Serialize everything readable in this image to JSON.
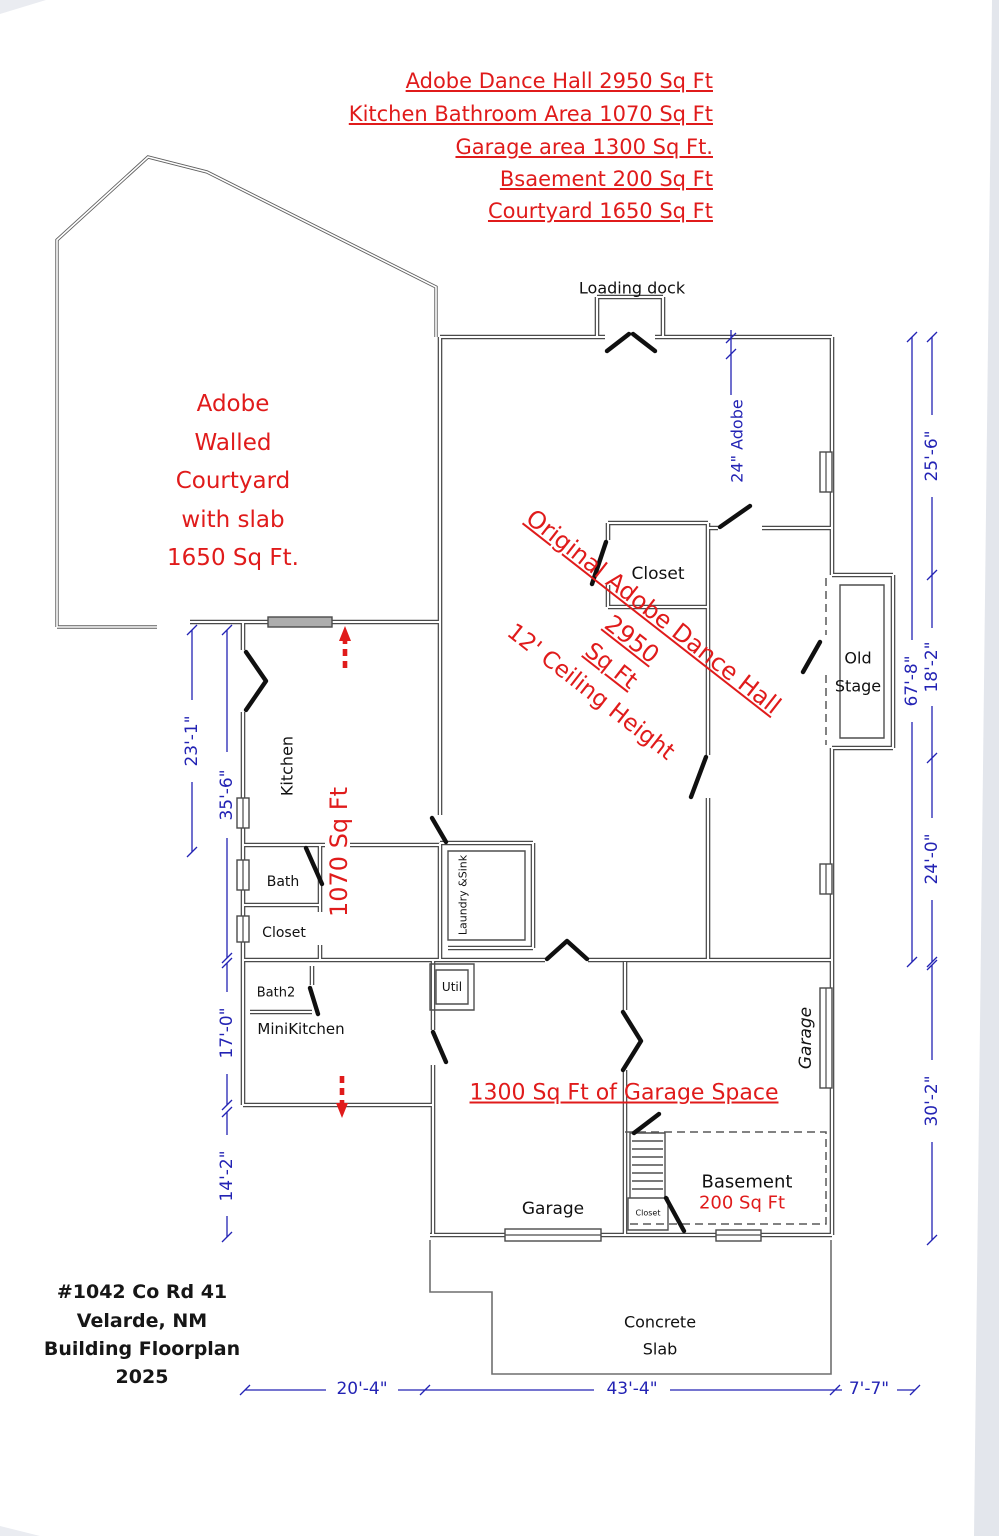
{
  "colors": {
    "annotation_red": "#e01b1b",
    "dimension_blue": "#2323b4",
    "wall_gray": "#4a4a4a"
  },
  "title": {
    "lines": [
      "Adobe Dance Hall 2950 Sq Ft",
      "Kitchen Bathroom Area 1070 Sq Ft",
      "Garage area 1300 Sq Ft.",
      "Bsaement 200 Sq Ft",
      "Courtyard 1650 Sq Ft"
    ]
  },
  "courtyard_label": {
    "lines": [
      "Adobe",
      "Walled",
      "Courtyard",
      "with slab",
      "1650 Sq Ft."
    ]
  },
  "hall_note": {
    "line1": "Original Adobe Dance Hall  2950",
    "line2": "Sq Ft",
    "line3": "12' Ceiling Height"
  },
  "labels": {
    "loading_dock": "Loading dock",
    "adobe_wall": "24\" Adobe",
    "closet_hall": "Closet",
    "old": "Old",
    "stage": "Stage",
    "kitchen": "Kitchen",
    "kitchen_sqft": "1070 Sq Ft",
    "bath": "Bath",
    "closet_kitchen": "Closet",
    "laundry": "Laundry &Sink",
    "bath2": "Bath2",
    "minikitchen": "MiniKitchen",
    "util": "Util",
    "garage_right": "Garage",
    "garage_note": "1300 Sq Ft of Garage Space",
    "garage_left": "Garage",
    "basement": "Basement",
    "basement_sqft": "200 Sq Ft",
    "stairs_closet": "Closet",
    "concrete": "Concrete",
    "slab": "Slab"
  },
  "dims": {
    "left": [
      "23'-1\"",
      "35'-6\"",
      "17'-0\"",
      "14'-2\""
    ],
    "right": [
      "25'-6\"",
      "18'-2\"",
      "67'-8\"",
      "24'-0\"",
      "30'-2\""
    ],
    "bottom": [
      "20'-4\"",
      "43'-4\"",
      "7'-7\""
    ]
  },
  "address": {
    "lines": [
      "#1042 Co Rd 41",
      "Velarde, NM",
      "Building Floorplan",
      "2025"
    ]
  }
}
